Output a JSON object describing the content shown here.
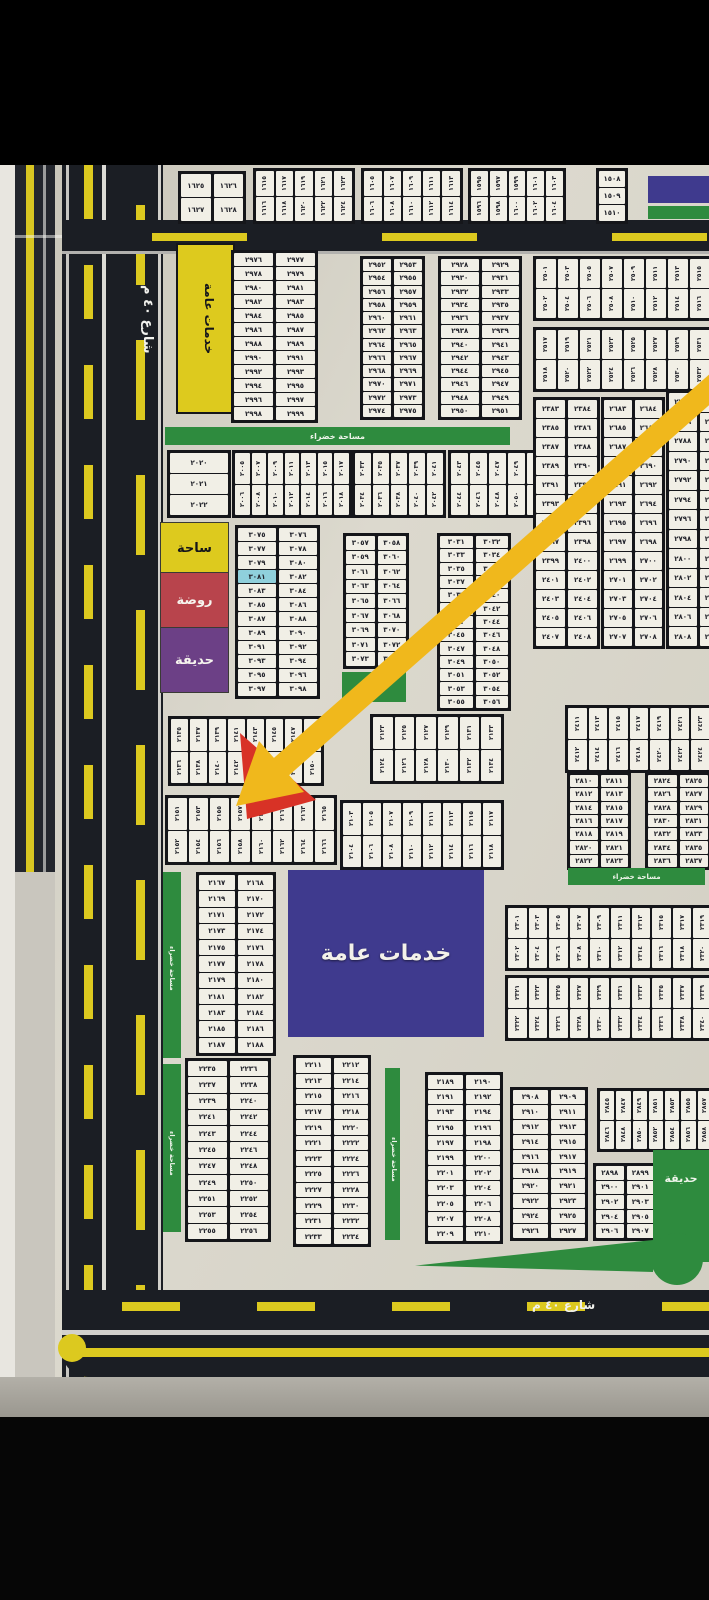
{
  "labels": {
    "street_left": "شارع ٤٠ م",
    "street_bottom": "شارع ٤٠ م",
    "public_services": "خدمات عامة",
    "green_area": "مساحة خضراء",
    "park": "حديقة"
  },
  "legend": [
    {
      "label": "ساحة",
      "color": "#ddca1e"
    },
    {
      "label": "روضة",
      "color": "#b8444c"
    },
    {
      "label": "حديقة",
      "color": "#6c4086"
    }
  ],
  "highlighted_plot": "٣٠٨١",
  "colors": {
    "board": "#d7d4c9",
    "road": "#1b1e24",
    "road_marking_yellow": "#dcc91f",
    "green_space": "#2e8b3e",
    "services_purple": "#3f3a8e",
    "services_yellow": "#ddca1e",
    "legend_red": "#b8444c",
    "legend_purple": "#6c4086",
    "highlight_cyan": "#8fd0dc",
    "arrow_yellow": "#f0b81c",
    "arrow_red": "#d83226"
  },
  "blocks": {
    "a1": {
      "type": "pairs",
      "rows": [
        [
          "١٦٢٦",
          "١٦٢٥"
        ],
        [
          "١٦٢٨",
          "١٦٢٧"
        ]
      ]
    },
    "a2": {
      "type": "hstrip",
      "rows": [
        [
          "١٦٢٣",
          "١٦٢١",
          "١٦١٩",
          "١٦١٧",
          "١٦١٥"
        ],
        [
          "١٦٢٤",
          "١٦٢٢",
          "١٦٢٠",
          "١٦١٨",
          "١٦١٦"
        ]
      ]
    },
    "a3": {
      "type": "hstrip",
      "rows": [
        [
          "١٦١٣",
          "١٦١١",
          "١٦٠٩",
          "١٦٠٧",
          "١٦٠٥"
        ],
        [
          "١٦١٤",
          "١٦١٢",
          "١٦١٠",
          "١٦٠٨",
          "١٦٠٦"
        ]
      ]
    },
    "a4": {
      "type": "hstrip",
      "rows": [
        [
          "١٦٠٣",
          "١٦٠١",
          "١٥٩٩",
          "١٥٩٧",
          "١٥٩٥"
        ],
        [
          "١٦٠٤",
          "١٦٠٢",
          "١٦٠٠",
          "١٥٩٨",
          "١٥٩٦"
        ]
      ]
    },
    "a5": {
      "type": "vstack",
      "rows": [
        "١٥٠٨",
        "١٥٠٩",
        "١٥١٠"
      ]
    },
    "b2": {
      "type": "pairs",
      "rows": [
        [
          "٢٩٧٧",
          "٢٩٧٦"
        ],
        [
          "٢٩٧٩",
          "٢٩٧٨"
        ],
        [
          "٢٩٨١",
          "٢٩٨٠"
        ],
        [
          "٢٩٨٣",
          "٢٩٨٢"
        ],
        [
          "٢٩٨٥",
          "٢٩٨٤"
        ],
        [
          "٢٩٨٧",
          "٢٩٨٦"
        ],
        [
          "٢٩٨٩",
          "٢٩٨٨"
        ],
        [
          "٢٩٩١",
          "٢٩٩٠"
        ],
        [
          "٢٩٩٣",
          "٢٩٩٢"
        ],
        [
          "٢٩٩٥",
          "٢٩٩٤"
        ],
        [
          "٢٩٩٧",
          "٢٩٩٦"
        ],
        [
          "٢٩٩٩",
          "٢٩٩٨"
        ]
      ]
    },
    "b3a": {
      "type": "pairs",
      "rows": [
        [
          "٢٩٥٣",
          "٢٩٥٢"
        ],
        [
          "٢٩٥٥",
          "٢٩٥٤"
        ],
        [
          "٢٩٥٧",
          "٢٩٥٦"
        ],
        [
          "٢٩٥٩",
          "٢٩٥٨"
        ],
        [
          "٢٩٦١",
          "٢٩٦٠"
        ],
        [
          "٢٩٦٣",
          "٢٩٦٢"
        ],
        [
          "٢٩٦٥",
          "٢٩٦٤"
        ],
        [
          "٢٩٦٧",
          "٢٩٦٦"
        ],
        [
          "٢٩٦٩",
          "٢٩٦٨"
        ],
        [
          "٢٩٧١",
          "٢٩٧٠"
        ],
        [
          "٢٩٧٣",
          "٢٩٧٢"
        ],
        [
          "٢٩٧٥",
          "٢٩٧٤"
        ]
      ]
    },
    "b3b": {
      "type": "pairs",
      "rows": [
        [
          "٢٩٢٩",
          "٢٩٢٨"
        ],
        [
          "٢٩٣١",
          "٢٩٣٠"
        ],
        [
          "٢٩٣٣",
          "٢٩٣٢"
        ],
        [
          "٢٩٣٥",
          "٢٩٣٤"
        ],
        [
          "٢٩٣٧",
          "٢٩٣٦"
        ],
        [
          "٢٩٣٩",
          "٢٩٣٨"
        ],
        [
          "٢٩٤١",
          "٢٩٤٠"
        ],
        [
          "٢٩٤٣",
          "٢٩٤٢"
        ],
        [
          "٢٩٤٥",
          "٢٩٤٤"
        ],
        [
          "٢٩٤٧",
          "٢٩٤٦"
        ],
        [
          "٢٩٤٩",
          "٢٩٤٨"
        ],
        [
          "٢٩٥١",
          "٢٩٥٠"
        ]
      ]
    },
    "b4a": {
      "type": "hstrip",
      "rows": [
        [
          "٢٥١٥",
          "٢٥١٣",
          "٢٥١١",
          "٢٥٠٩",
          "٢٥٠٧",
          "٢٥٠٥",
          "٢٥٠٣",
          "٢٥٠١"
        ],
        [
          "٢٥١٦",
          "٢٥١٤",
          "٢٥١٢",
          "٢٥١٠",
          "٢٥٠٨",
          "٢٥٠٦",
          "٢٥٠٤",
          "٢٥٠٢"
        ]
      ]
    },
    "b4b": {
      "type": "hstrip",
      "rows": [
        [
          "٢٥٣١",
          "٢٥٢٩",
          "٢٥٢٧",
          "٢٥٢٥",
          "٢٥٢٣",
          "٢٥٢١",
          "٢٥١٩",
          "٢٥١٧"
        ],
        [
          "٢٥٣٢",
          "٢٥٣٠",
          "٢٥٢٨",
          "٢٥٢٦",
          "٢٥٢٤",
          "٢٥٢٢",
          "٢٥٢٠",
          "٢٥١٨"
        ]
      ]
    },
    "r1": {
      "type": "pairs",
      "rows": [
        [
          "٢٣٨٤",
          "٢٣٨٣"
        ],
        [
          "٢٣٨٦",
          "٢٣٨٥"
        ],
        [
          "٢٣٨٨",
          "٢٣٨٧"
        ],
        [
          "٢٣٩٠",
          "٢٣٨٩"
        ],
        [
          "٢٣٩٢",
          "٢٣٩١"
        ],
        [
          "٢٣٩٤",
          "٢٣٩٣"
        ],
        [
          "٢٣٩٦",
          "٢٣٩٥"
        ],
        [
          "٢٣٩٨",
          "٢٣٩٧"
        ],
        [
          "٢٤٠٠",
          "٢٣٩٩"
        ],
        [
          "٢٤٠٢",
          "٢٤٠١"
        ],
        [
          "٢٤٠٤",
          "٢٤٠٣"
        ],
        [
          "٢٤٠٦",
          "٢٤٠٥"
        ],
        [
          "٢٤٠٨",
          "٢٤٠٧"
        ]
      ]
    },
    "r2": {
      "type": "pairs",
      "rows": [
        [
          "٢٦٨٤",
          "٢٦٨٣"
        ],
        [
          "٢٦٨٦",
          "٢٦٨٥"
        ],
        [
          "٢٦٨٨",
          "٢٦٨٧"
        ],
        [
          "٢٦٩٠",
          "٢٦٨٩"
        ],
        [
          "٢٦٩٢",
          "٢٦٩١"
        ],
        [
          "٢٦٩٤",
          "٢٦٩٣"
        ],
        [
          "٢٦٩٦",
          "٢٦٩٥"
        ],
        [
          "٢٦٩٨",
          "٢٦٩٧"
        ],
        [
          "٢٧٠٠",
          "٢٦٩٩"
        ],
        [
          "٢٧٠٢",
          "٢٧٠١"
        ],
        [
          "٢٧٠٤",
          "٢٧٠٣"
        ],
        [
          "٢٧٠٦",
          "٢٧٠٥"
        ],
        [
          "٢٧٠٨",
          "٢٧٠٧"
        ]
      ]
    },
    "r3": {
      "type": "pairs",
      "rows": [
        [
          "٢٧٨٥",
          "٢٧٨٤"
        ],
        [
          "٢٧٨٧",
          "٢٧٨٦"
        ],
        [
          "٢٧٨٩",
          "٢٧٨٨"
        ],
        [
          "٢٧٩١",
          "٢٧٩٠"
        ],
        [
          "٢٧٩٣",
          "٢٧٩٢"
        ],
        [
          "٢٧٩٥",
          "٢٧٩٤"
        ],
        [
          "٢٧٩٧",
          "٢٧٩٦"
        ],
        [
          "٢٧٩٩",
          "٢٧٩٨"
        ],
        [
          "٢٨٠١",
          "٢٨٠٠"
        ],
        [
          "٢٨٠٣",
          "٢٨٠٢"
        ],
        [
          "٢٨٠٥",
          "٢٨٠٤"
        ],
        [
          "٢٨٠٧",
          "٢٨٠٦"
        ],
        [
          "٢٨٠٩",
          "٢٨٠٨"
        ]
      ]
    },
    "c1": {
      "type": "vstack",
      "rows": [
        "٢٠٢٠",
        "٢٠٢١",
        "٢٠٢٢"
      ]
    },
    "c2": {
      "type": "hstrip",
      "rows": [
        [
          "٢٠١٧",
          "٢٠١٥",
          "٢٠١٣",
          "٢٠١١",
          "٢٠٠٩",
          "٢٠٠٧",
          "٢٠٠٥"
        ],
        [
          "٢٠١٨",
          "٢٠١٦",
          "٢٠١٤",
          "٢٠١٢",
          "٢٠١٠",
          "٢٠٠٨",
          "٢٠٠٦"
        ]
      ]
    },
    "c3": {
      "type": "hstrip",
      "rows": [
        [
          "٢٠٤١",
          "٢٠٣٩",
          "٢٠٣٧",
          "٢٠٣٥",
          "٢٠٣٣"
        ],
        [
          "٢٠٤٢",
          "٢٠٤٠",
          "٢٠٣٨",
          "٢٠٣٦",
          "٢٠٣٤"
        ]
      ]
    },
    "c4": {
      "type": "hstrip",
      "rows": [
        [
          "٢٠٥٣",
          "٢٠٥١",
          "٢٠٤٩",
          "٢٠٤٧",
          "٢٠٤٥",
          "٢٠٤٣"
        ],
        [
          "٢٠٥٤",
          "٢٠٥٢",
          "٢٠٥٠",
          "٢٠٤٨",
          "٢٠٤٦",
          "٢٠٤٤"
        ]
      ]
    },
    "d1": {
      "type": "pairs",
      "highlight": [
        "٣٠٨١"
      ],
      "rows": [
        [
          "٣٠٧٦",
          "٣٠٧٥"
        ],
        [
          "٣٠٧٨",
          "٣٠٧٧"
        ],
        [
          "٣٠٨٠",
          "٣٠٧٩"
        ],
        [
          "٣٠٨٢",
          "٣٠٨١"
        ],
        [
          "٣٠٨٤",
          "٣٠٨٣"
        ],
        [
          "٣٠٨٦",
          "٣٠٨٥"
        ],
        [
          "٣٠٨٨",
          "٣٠٨٧"
        ],
        [
          "٣٠٩٠",
          "٣٠٨٩"
        ],
        [
          "٣٠٩٢",
          "٣٠٩١"
        ],
        [
          "٣٠٩٤",
          "٣٠٩٣"
        ],
        [
          "٣٠٩٦",
          "٣٠٩٥"
        ],
        [
          "٣٠٩٨",
          "٣٠٩٧"
        ]
      ]
    },
    "d2": {
      "type": "pairs",
      "rows": [
        [
          "٣٠٥٨",
          "٣٠٥٧"
        ],
        [
          "٣٠٦٠",
          "٣٠٥٩"
        ],
        [
          "٣٠٦٢",
          "٣٠٦١"
        ],
        [
          "٣٠٦٤",
          "٣٠٦٣"
        ],
        [
          "٣٠٦٦",
          "٣٠٦٥"
        ],
        [
          "٣٠٦٨",
          "٣٠٦٧"
        ],
        [
          "٣٠٧٠",
          "٣٠٦٩"
        ],
        [
          "٣٠٧٢",
          "٣٠٧١"
        ],
        [
          "٣٠٧٤",
          "٣٠٧٣"
        ]
      ]
    },
    "d3": {
      "type": "pairs",
      "rows": [
        [
          "٣٠٣٢",
          "٣٠٣١"
        ],
        [
          "٣٠٣٤",
          "٣٠٣٣"
        ],
        [
          "٣٠٣٦",
          "٣٠٣٥"
        ],
        [
          "٣٠٣٨",
          "٣٠٣٧"
        ],
        [
          "٣٠٤٠",
          "٣٠٣٩"
        ],
        [
          "٣٠٤٢",
          "٣٠٤١"
        ],
        [
          "٣٠٤٤",
          "٣٠٤٣"
        ],
        [
          "٣٠٤٦",
          "٣٠٤٥"
        ],
        [
          "٣٠٤٨",
          "٣٠٤٧"
        ],
        [
          "٣٠٥٠",
          "٣٠٤٩"
        ],
        [
          "٣٠٥٢",
          "٣٠٥١"
        ],
        [
          "٣٠٥٤",
          "٣٠٥٣"
        ],
        [
          "٣٠٥٦",
          "٣٠٥٥"
        ]
      ]
    },
    "e1": {
      "type": "hstrip",
      "rows": [
        [
          "٢١٤٩",
          "٢١٤٧",
          "٢١٤٥",
          "٢١٤٣",
          "٢١٤١",
          "٢١٣٩",
          "٢١٣٧",
          "٢١٣٥"
        ],
        [
          "٢١٥٠",
          "٢١٤٨",
          "٢١٤٦",
          "٢١٤٤",
          "٢١٤٢",
          "٢١٤٠",
          "٢١٣٨",
          "٢١٣٦"
        ]
      ]
    },
    "e2": {
      "type": "hstrip",
      "rows": [
        [
          "٢١٣٣",
          "٢١٣١",
          "٢١٢٩",
          "٢١٢٧",
          "٢١٢٥",
          "٢١٢٣"
        ],
        [
          "٢١٣٤",
          "٢١٣٢",
          "٢١٣٠",
          "٢١٢٨",
          "٢١٢٦",
          "٢١٢٤"
        ]
      ]
    },
    "e3": {
      "type": "hstrip",
      "rows": [
        [
          "٢٤٢٣",
          "٢٤٢١",
          "٢٤١٩",
          "٢٤١٧",
          "٢٤١٥",
          "٢٤١٣",
          "٢٤١١"
        ],
        [
          "٢٤٢٤",
          "٢٤٢٢",
          "٢٤٢٠",
          "٢٤١٨",
          "٢٤١٦",
          "٢٤١٤",
          "٢٤١٢"
        ]
      ]
    },
    "f1": {
      "type": "hstrip",
      "rows": [
        [
          "٢١٦٥",
          "٢١٦٣",
          "٢١٦١",
          "٢١٥٩",
          "٢١٥٧",
          "٢١٥٥",
          "٢١٥٣",
          "٢١٥١"
        ],
        [
          "٢١٦٦",
          "٢١٦٤",
          "٢١٦٢",
          "٢١٦٠",
          "٢١٥٨",
          "٢١٥٦",
          "٢١٥٤",
          "٢١٥٢"
        ]
      ]
    },
    "f2": {
      "type": "hstrip",
      "rows": [
        [
          "٢١١٧",
          "٢١١٥",
          "٢١١٣",
          "٢١١١",
          "٢١٠٩",
          "٢١٠٧",
          "٢١٠٥",
          "٢١٠٣"
        ],
        [
          "٢١١٨",
          "٢١١٦",
          "٢١١٤",
          "٢١١٢",
          "٢١١٠",
          "٢١٠٨",
          "٢١٠٦",
          "٢١٠٤"
        ]
      ]
    },
    "f3": {
      "type": "pairs",
      "rows": [
        [
          "٢٨١١",
          "٢٨١٠"
        ],
        [
          "٢٨١٣",
          "٢٨١٢"
        ],
        [
          "٢٨١٥",
          "٢٨١٤"
        ],
        [
          "٢٨١٧",
          "٢٨١٦"
        ],
        [
          "٢٨١٩",
          "٢٨١٨"
        ],
        [
          "٢٨٢١",
          "٢٨٢٠"
        ],
        [
          "٢٨٢٣",
          "٢٨٢٢"
        ]
      ]
    },
    "f4": {
      "type": "pairs",
      "rows": [
        [
          "٢٨٢٥",
          "٢٨٢٤"
        ],
        [
          "٢٨٢٧",
          "٢٨٢٦"
        ],
        [
          "٢٨٢٩",
          "٢٨٢٨"
        ],
        [
          "٢٨٣١",
          "٢٨٣٠"
        ],
        [
          "٢٨٣٣",
          "٢٨٣٢"
        ],
        [
          "٢٨٣٥",
          "٢٨٣٤"
        ],
        [
          "٢٨٣٧",
          "٢٨٣٦"
        ]
      ]
    },
    "g1": {
      "type": "pairs",
      "rows": [
        [
          "٢١٦٨",
          "٢١٦٧"
        ],
        [
          "٢١٧٠",
          "٢١٦٩"
        ],
        [
          "٢١٧٢",
          "٢١٧١"
        ],
        [
          "٢١٧٤",
          "٢١٧٣"
        ],
        [
          "٢١٧٦",
          "٢١٧٥"
        ],
        [
          "٢١٧٨",
          "٢١٧٧"
        ],
        [
          "٢١٨٠",
          "٢١٧٩"
        ],
        [
          "٢١٨٢",
          "٢١٨١"
        ],
        [
          "٢١٨٤",
          "٢١٨٣"
        ],
        [
          "٢١٨٦",
          "٢١٨٥"
        ],
        [
          "٢١٨٨",
          "٢١٨٧"
        ]
      ]
    },
    "h1": {
      "type": "hstrip",
      "rows": [
        [
          "٢٣١٩",
          "٢٣١٧",
          "٢٣١٥",
          "٢٣١٣",
          "٢٣١١",
          "٢٣٠٩",
          "٢٣٠٧",
          "٢٣٠٥",
          "٢٣٠٣",
          "٢٣٠١"
        ],
        [
          "٢٣٢٠",
          "٢٣١٨",
          "٢٣١٦",
          "٢٣١٤",
          "٢٣١٢",
          "٢٣١٠",
          "٢٣٠٨",
          "٢٣٠٦",
          "٢٣٠٤",
          "٢٣٠٢"
        ]
      ]
    },
    "h2": {
      "type": "hstrip",
      "rows": [
        [
          "٢٣٣٩",
          "٢٣٣٧",
          "٢٣٣٥",
          "٢٣٣٣",
          "٢٣٣١",
          "٢٣٢٩",
          "٢٣٢٧",
          "٢٣٢٥",
          "٢٣٢٣",
          "٢٣٢١"
        ],
        [
          "٢٣٤٠",
          "٢٣٣٨",
          "٢٣٣٦",
          "٢٣٣٤",
          "٢٣٣٢",
          "٢٣٣٠",
          "٢٣٢٨",
          "٢٣٢٦",
          "٢٣٢٤",
          "٢٣٢٢"
        ]
      ]
    },
    "i1": {
      "type": "pairs",
      "rows": [
        [
          "٢٢٣٦",
          "٢٢٣٥"
        ],
        [
          "٢٢٣٨",
          "٢٢٣٧"
        ],
        [
          "٢٢٤٠",
          "٢٢٣٩"
        ],
        [
          "٢٢٤٢",
          "٢٢٤١"
        ],
        [
          "٢٢٤٤",
          "٢٢٤٣"
        ],
        [
          "٢٢٤٦",
          "٢٢٤٥"
        ],
        [
          "٢٢٤٨",
          "٢٢٤٧"
        ],
        [
          "٢٢٥٠",
          "٢٢٤٩"
        ],
        [
          "٢٢٥٢",
          "٢٢٥١"
        ],
        [
          "٢٢٥٤",
          "٢٢٥٣"
        ],
        [
          "٢٢٥٦",
          "٢٢٥٥"
        ]
      ]
    },
    "i2": {
      "type": "pairs",
      "rows": [
        [
          "٢٢١٢",
          "٢٢١١"
        ],
        [
          "٢٢١٤",
          "٢٢١٣"
        ],
        [
          "٢٢١٦",
          "٢٢١٥"
        ],
        [
          "٢٢١٨",
          "٢٢١٧"
        ],
        [
          "٢٢٢٠",
          "٢٢١٩"
        ],
        [
          "٢٢٢٢",
          "٢٢٢١"
        ],
        [
          "٢٢٢٤",
          "٢٢٢٣"
        ],
        [
          "٢٢٢٦",
          "٢٢٢٥"
        ],
        [
          "٢٢٢٨",
          "٢٢٢٧"
        ],
        [
          "٢٢٣٠",
          "٢٢٢٩"
        ],
        [
          "٢٢٣٢",
          "٢٢٣١"
        ],
        [
          "٢٢٣٤",
          "٢٢٣٣"
        ]
      ]
    },
    "i3": {
      "type": "pairs",
      "rows": [
        [
          "٢١٩٠",
          "٢١٨٩"
        ],
        [
          "٢١٩٢",
          "٢١٩١"
        ],
        [
          "٢١٩٤",
          "٢١٩٣"
        ],
        [
          "٢١٩٦",
          "٢١٩٥"
        ],
        [
          "٢١٩٨",
          "٢١٩٧"
        ],
        [
          "٢٢٠٠",
          "٢١٩٩"
        ],
        [
          "٢٢٠٢",
          "٢٢٠١"
        ],
        [
          "٢٢٠٤",
          "٢٢٠٣"
        ],
        [
          "٢٢٠٦",
          "٢٢٠٥"
        ],
        [
          "٢٢٠٨",
          "٢٢٠٧"
        ],
        [
          "٢٢١٠",
          "٢٢٠٩"
        ]
      ]
    },
    "i4": {
      "type": "pairs",
      "rows": [
        [
          "٢٩٠٩",
          "٢٩٠٨"
        ],
        [
          "٢٩١١",
          "٢٩١٠"
        ],
        [
          "٢٩١٣",
          "٢٩١٢"
        ],
        [
          "٢٩١٥",
          "٢٩١٤"
        ],
        [
          "٢٩١٧",
          "٢٩١٦"
        ],
        [
          "٢٩١٩",
          "٢٩١٨"
        ],
        [
          "٢٩٢١",
          "٢٩٢٠"
        ],
        [
          "٢٩٢٣",
          "٢٩٢٢"
        ],
        [
          "٢٩٢٥",
          "٢٩٢٤"
        ],
        [
          "٢٩٢٧",
          "٢٩٢٦"
        ]
      ]
    },
    "i5": {
      "type": "pairs",
      "rows": [
        [
          "٢٨٩٩",
          "٢٨٩٨"
        ],
        [
          "٢٩٠١",
          "٢٩٠٠"
        ],
        [
          "٢٩٠٣",
          "٢٩٠٢"
        ],
        [
          "٢٩٠٥",
          "٢٩٠٤"
        ],
        [
          "٢٩٠٧",
          "٢٩٠٦"
        ]
      ]
    },
    "i6": {
      "type": "hstrip",
      "rows": [
        [
          "٢٨٥٧",
          "٢٨٥٥",
          "٢٨٥٣",
          "٢٨٥١",
          "٢٨٤٩",
          "٢٨٤٧",
          "٢٨٤٥"
        ],
        [
          "٢٨٥٨",
          "٢٨٥٦",
          "٢٨٥٤",
          "٢٨٥٢",
          "٢٨٥٠",
          "٢٨٤٨",
          "٢٨٤٦"
        ]
      ]
    }
  }
}
